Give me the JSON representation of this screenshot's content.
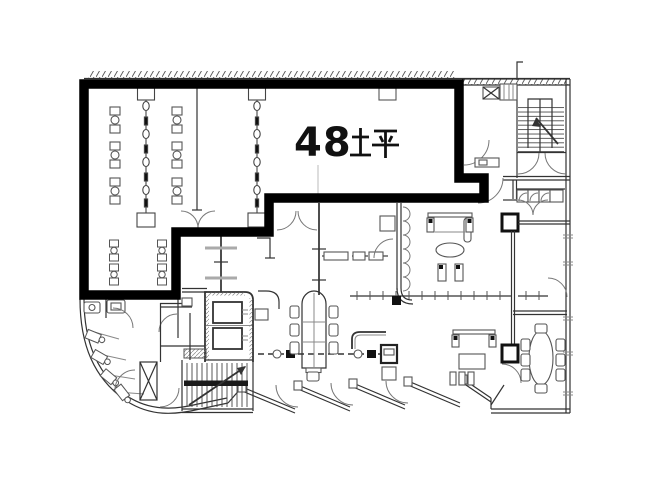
{
  "floor_plan": {
    "area": {
      "label": "48坪",
      "number": "48",
      "unit": "坪"
    },
    "colors": {
      "premises_outline": "#000000",
      "walls": "#333333",
      "furniture": "#555555",
      "background": "#ffffff"
    }
  }
}
